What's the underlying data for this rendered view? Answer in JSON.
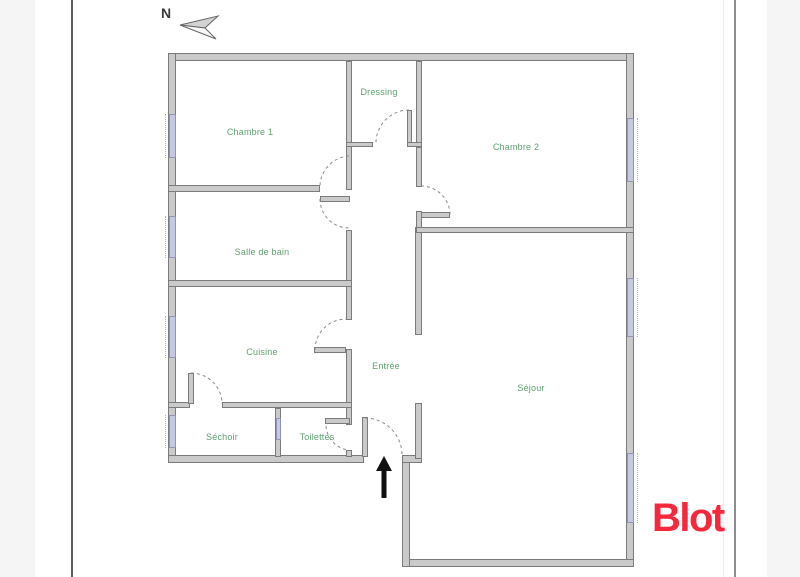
{
  "compass": {
    "label": "N"
  },
  "rooms": {
    "chambre1": "Chambre 1",
    "dressing": "Dressing",
    "chambre2": "Chambre 2",
    "salle_de_bain": "Salle de bain",
    "cuisine": "Cuisine",
    "entree": "Entrée",
    "sejour": "Séjour",
    "sechoir": "Séchoir",
    "toilettes": "Toilettes"
  },
  "branding": {
    "logo_text": "Blot",
    "logo_color": "#f5283c"
  },
  "colors": {
    "room_label_green": "#5d9f6e",
    "wall_fill": "#cacaca",
    "wall_edge": "#7b7b7b",
    "window_fill": "#c5c9e4",
    "door_arc": "#8a8a8a",
    "entrance_arrow": "#111111",
    "page_background": "#ffffff"
  }
}
